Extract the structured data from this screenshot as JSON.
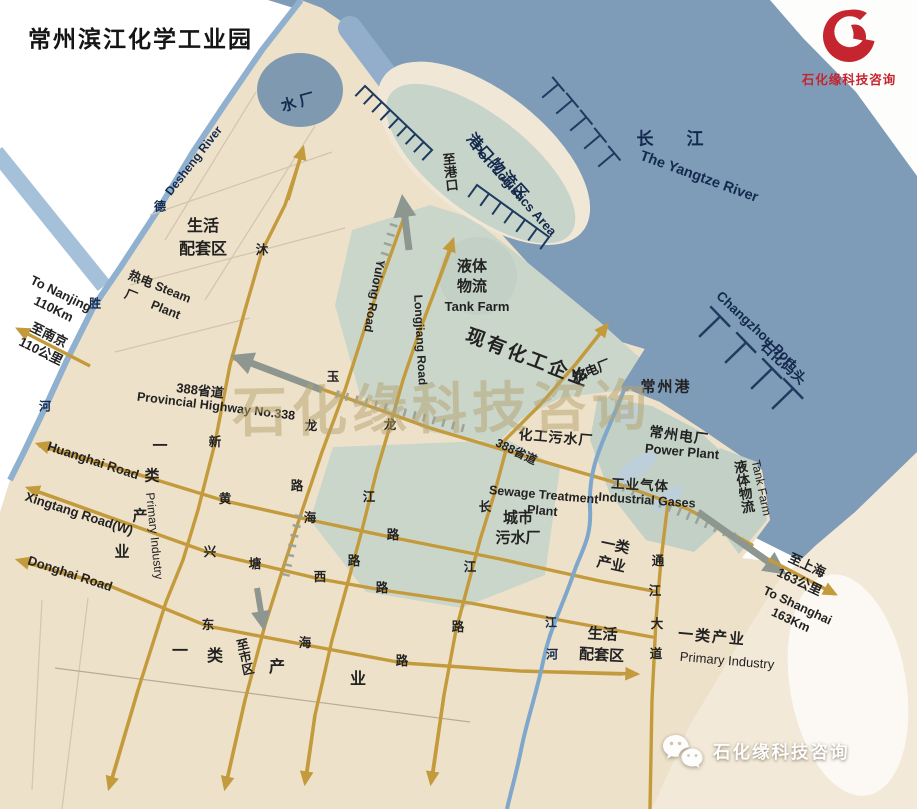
{
  "title": "常州滨江化学工业园",
  "brand": {
    "name": "石化缘科技咨询",
    "logo_color": "#c5252e"
  },
  "watermark": {
    "center_text": "石化缘科技咨询",
    "wechat_text": "石化缘科技咨询"
  },
  "colors": {
    "river": "#7e9bb8",
    "land": "#eee1ca",
    "zone": "#cbd6cb",
    "zone_dark": "#c2d0c5",
    "road": "#c49b3c",
    "rail": "#9aa096",
    "river_line": "#8fb0cf",
    "stream": "#7fa7cc",
    "water_plant": "#7e99b0",
    "pier": "#1d3a5f",
    "label_navy": "#13294d",
    "label_ink": "#222222",
    "cream": "#f2e9d8",
    "watermark_tan": "#b5a470",
    "arrow_gray": "#8e9690",
    "port_teal": "#c7d4c9",
    "port_rim": "#f1e7d6",
    "minor_line": "#d2c5ae",
    "pale_pond": "#bccfda"
  },
  "map": {
    "labels": [
      {
        "n": "label-water-plant",
        "t": "水厂",
        "x": 300,
        "y": 103,
        "s": 15,
        "b": 1,
        "c": "navy",
        "r": -15,
        "ls": 4
      },
      {
        "n": "label-to-port",
        "t": "至港口",
        "x": 449,
        "y": 172,
        "s": 13,
        "b": 1,
        "c": "ink",
        "v": 1,
        "r": -6
      },
      {
        "n": "label-port-logistics-cn",
        "t": "港口物流区",
        "x": 497,
        "y": 168,
        "s": 15,
        "b": 1,
        "c": "navy",
        "r": 48,
        "ls": 2
      },
      {
        "n": "label-port-logistics-en",
        "t": "Port Logistics Area",
        "x": 514,
        "y": 190,
        "s": 13,
        "b": 1,
        "c": "navy",
        "r": 48
      },
      {
        "n": "label-yangtze-cn",
        "t": "长　江",
        "x": 674,
        "y": 139,
        "s": 17,
        "b": 1,
        "c": "navy",
        "ls": 8
      },
      {
        "n": "label-yangtze-en",
        "t": "The Yangtze River",
        "x": 699,
        "y": 177,
        "s": 14.5,
        "b": 1,
        "c": "navy",
        "r": 20
      },
      {
        "n": "label-changzhou-port-en",
        "t": "Changzhou Port",
        "x": 756,
        "y": 330,
        "s": 13.5,
        "b": 1,
        "c": "navy",
        "r": 43
      },
      {
        "n": "label-shihua-wharf",
        "t": "石化码头",
        "x": 783,
        "y": 363,
        "s": 14,
        "b": 1,
        "c": "navy",
        "r": 43
      },
      {
        "n": "label-desheng-river-en",
        "t": "Desheng River",
        "x": 194,
        "y": 161,
        "s": 12,
        "b": 1,
        "c": "navy",
        "r": -52
      },
      {
        "n": "river-char",
        "t": "德",
        "x": 160,
        "y": 207,
        "s": 12,
        "b": 1,
        "c": "navy"
      },
      {
        "n": "river-char",
        "t": "胜",
        "x": 95,
        "y": 304,
        "s": 12,
        "b": 1,
        "c": "navy"
      },
      {
        "n": "river-char",
        "t": "河",
        "x": 45,
        "y": 407,
        "s": 12,
        "b": 1,
        "c": "navy"
      },
      {
        "n": "label-living-area-nw",
        "t": "生活\n配套区",
        "x": 203,
        "y": 238,
        "s": 16,
        "b": 1,
        "c": "ink",
        "lh": 1.45
      },
      {
        "n": "label-steam-plant",
        "t": "热电 Steam\n厂　 Plant",
        "x": 156,
        "y": 296,
        "s": 12.5,
        "b": 1,
        "c": "ink",
        "r": 22,
        "lh": 1.5
      },
      {
        "n": "label-to-nanjing-en",
        "t": "To Nanjing\n110Km",
        "x": 57,
        "y": 302,
        "s": 13,
        "b": 1,
        "c": "ink",
        "r": 26,
        "lh": 1.3
      },
      {
        "n": "label-to-nanjing-cn",
        "t": "至南京\n110公里",
        "x": 45,
        "y": 343,
        "s": 13,
        "b": 1,
        "c": "ink",
        "r": 26,
        "lh": 1.35
      },
      {
        "n": "label-hw388-w-cn",
        "t": "388省道",
        "x": 200,
        "y": 391,
        "s": 13,
        "b": 1,
        "c": "ink",
        "r": 7
      },
      {
        "n": "label-hw388-w-en",
        "t": "Provincial Highway No.338",
        "x": 216,
        "y": 407,
        "s": 12.5,
        "b": 1,
        "c": "ink",
        "r": 7
      },
      {
        "n": "label-tank-farm-n-cn",
        "t": "液体\n物流",
        "x": 472,
        "y": 277,
        "s": 15,
        "b": 1,
        "c": "ink",
        "lh": 1.35
      },
      {
        "n": "label-tank-farm-n-en",
        "t": "Tank Farm",
        "x": 477,
        "y": 307,
        "s": 13,
        "b": 1,
        "c": "ink"
      },
      {
        "n": "label-existing-chem",
        "t": "现有化工企业",
        "x": 528,
        "y": 359,
        "s": 19,
        "b": 1,
        "c": "ink",
        "r": 21,
        "ls": 3
      },
      {
        "n": "label-thermal-plant",
        "t": "热电厂",
        "x": 592,
        "y": 371,
        "s": 13,
        "b": 1,
        "c": "ink",
        "r": -22
      },
      {
        "n": "label-changzhou-port-cn",
        "t": "常州港",
        "x": 666,
        "y": 388,
        "s": 15,
        "b": 1,
        "c": "ink",
        "ls": 2
      },
      {
        "n": "label-power-plant-cn",
        "t": "常州电厂",
        "x": 679,
        "y": 436,
        "s": 14,
        "b": 1,
        "c": "ink",
        "r": 8,
        "ls": 1
      },
      {
        "n": "label-power-plant-en",
        "t": "Power Plant",
        "x": 682,
        "y": 452,
        "s": 13,
        "b": 1,
        "c": "ink",
        "r": 5
      },
      {
        "n": "label-chem-sewage",
        "t": "化工污水厂",
        "x": 556,
        "y": 438,
        "s": 14,
        "b": 1,
        "c": "ink",
        "r": 5,
        "ls": 1
      },
      {
        "n": "label-hw388-mid",
        "t": "388省道",
        "x": 516,
        "y": 452,
        "s": 12,
        "b": 1,
        "c": "ink",
        "r": 26
      },
      {
        "n": "label-sewage-en",
        "t": "Sewage Treatment\nPlant",
        "x": 543,
        "y": 503,
        "s": 12.5,
        "b": 1,
        "c": "ink",
        "r": 5,
        "lh": 1.3
      },
      {
        "n": "label-city-sewage",
        "t": "城市\n污水厂",
        "x": 518,
        "y": 528,
        "s": 15,
        "b": 1,
        "c": "ink",
        "lh": 1.3
      },
      {
        "n": "label-industrial-gases-cn",
        "t": "工业气体",
        "x": 640,
        "y": 486,
        "s": 13.5,
        "b": 1,
        "c": "ink",
        "r": 3,
        "ls": 1
      },
      {
        "n": "label-industrial-gases-en",
        "t": "Industrial Gases",
        "x": 647,
        "y": 501,
        "s": 12.5,
        "b": 1,
        "c": "ink",
        "r": 4
      },
      {
        "n": "label-tank-farm-e-cn",
        "t": "液体物流",
        "x": 742,
        "y": 487,
        "s": 13.5,
        "b": 1,
        "c": "ink",
        "v": 1,
        "r": -10
      },
      {
        "n": "label-tank-farm-e-en",
        "t": "Tank Farm",
        "x": 761,
        "y": 488,
        "s": 12,
        "b": 0,
        "c": "ink",
        "r": 78
      },
      {
        "n": "label-primary-industry-e",
        "t": "一类\n产业",
        "x": 613,
        "y": 556,
        "s": 14.5,
        "b": 1,
        "c": "ink",
        "r": 12,
        "lh": 1.3
      },
      {
        "n": "road-char",
        "t": "通",
        "x": 658,
        "y": 562,
        "s": 12.5,
        "b": 1,
        "c": "ink"
      },
      {
        "n": "road-char",
        "t": "江",
        "x": 655,
        "y": 592,
        "s": 12.5,
        "b": 1,
        "c": "ink"
      },
      {
        "n": "road-char",
        "t": "大",
        "x": 657,
        "y": 625,
        "s": 12.5,
        "b": 1,
        "c": "ink"
      },
      {
        "n": "road-char",
        "t": "道",
        "x": 656,
        "y": 655,
        "s": 12.5,
        "b": 1,
        "c": "ink"
      },
      {
        "n": "label-to-shanghai-cn",
        "t": "至上海\n163公里",
        "x": 803,
        "y": 574,
        "s": 13,
        "b": 1,
        "c": "ink",
        "r": 25,
        "lh": 1.4
      },
      {
        "n": "label-to-shanghai-en",
        "t": "To Shanghai\n163Km",
        "x": 794,
        "y": 613,
        "s": 12.5,
        "b": 1,
        "c": "ink",
        "r": 25,
        "lh": 1.3
      },
      {
        "n": "label-primary-industry-se-cn",
        "t": "一类产业",
        "x": 712,
        "y": 638,
        "s": 15,
        "b": 1,
        "c": "ink",
        "ls": 2,
        "r": 5
      },
      {
        "n": "label-primary-industry-se-en",
        "t": "Primary Industry",
        "x": 727,
        "y": 661,
        "s": 13,
        "b": 0,
        "c": "ink",
        "r": 5
      },
      {
        "n": "label-living-area-s",
        "t": "生活\n配套区",
        "x": 602,
        "y": 645,
        "s": 15,
        "b": 1,
        "c": "ink",
        "r": 3,
        "lh": 1.4
      },
      {
        "n": "label-huanghai-road",
        "t": "Huanghai Road",
        "x": 93,
        "y": 461,
        "s": 13,
        "b": 1,
        "c": "ink",
        "r": 18
      },
      {
        "n": "label-xingtang-road",
        "t": "Xingtang Road(W)",
        "x": 79,
        "y": 514,
        "s": 13,
        "b": 1,
        "c": "ink",
        "r": 18
      },
      {
        "n": "label-donghai-road",
        "t": "Donghai Road",
        "x": 70,
        "y": 574,
        "s": 13,
        "b": 1,
        "c": "ink",
        "r": 18
      },
      {
        "n": "label-primary-industry-w-char",
        "t": "一",
        "x": 160,
        "y": 447,
        "s": 15,
        "b": 1,
        "c": "ink"
      },
      {
        "n": "label-primary-industry-w-char",
        "t": "类",
        "x": 152,
        "y": 477,
        "s": 15,
        "b": 1,
        "c": "ink"
      },
      {
        "n": "label-primary-industry-w-char",
        "t": "产",
        "x": 140,
        "y": 517,
        "s": 15,
        "b": 1,
        "c": "ink"
      },
      {
        "n": "label-primary-industry-w-char",
        "t": "业",
        "x": 122,
        "y": 553,
        "s": 15,
        "b": 1,
        "c": "ink"
      },
      {
        "n": "label-primary-industry-w-en",
        "t": "Primary Industry",
        "x": 154,
        "y": 536,
        "s": 12,
        "b": 0,
        "c": "ink",
        "r": 84
      },
      {
        "n": "label-yulong-road",
        "t": "Yulong Road",
        "x": 374,
        "y": 296,
        "s": 12,
        "b": 1,
        "c": "ink",
        "r": 100
      },
      {
        "n": "label-longjiang-road",
        "t": "Longjiang Road",
        "x": 420,
        "y": 340,
        "s": 12,
        "b": 1,
        "c": "ink",
        "r": 87
      },
      {
        "n": "road-char",
        "t": "玉",
        "x": 333,
        "y": 378,
        "s": 12.5,
        "b": 1,
        "c": "ink"
      },
      {
        "n": "road-char",
        "t": "龙",
        "x": 311,
        "y": 427,
        "s": 12.5,
        "b": 1,
        "c": "ink"
      },
      {
        "n": "road-char",
        "t": "路",
        "x": 297,
        "y": 487,
        "s": 12.5,
        "b": 1,
        "c": "ink"
      },
      {
        "n": "road-char",
        "t": "沐",
        "x": 262,
        "y": 251,
        "s": 12.5,
        "b": 1,
        "c": "ink"
      },
      {
        "n": "road-char",
        "t": "新",
        "x": 215,
        "y": 443,
        "s": 12.5,
        "b": 1,
        "c": "ink"
      },
      {
        "n": "road-char",
        "t": "龙",
        "x": 390,
        "y": 426,
        "s": 12.5,
        "b": 1,
        "c": "ink"
      },
      {
        "n": "road-char",
        "t": "江",
        "x": 369,
        "y": 498,
        "s": 12.5,
        "b": 1,
        "c": "ink"
      },
      {
        "n": "road-char",
        "t": "路",
        "x": 354,
        "y": 562,
        "s": 12.5,
        "b": 1,
        "c": "ink"
      },
      {
        "n": "road-char",
        "t": "长",
        "x": 485,
        "y": 508,
        "s": 12.5,
        "b": 1,
        "c": "ink"
      },
      {
        "n": "road-char",
        "t": "江",
        "x": 470,
        "y": 568,
        "s": 12.5,
        "b": 1,
        "c": "ink"
      },
      {
        "n": "road-char",
        "t": "路",
        "x": 458,
        "y": 628,
        "s": 12.5,
        "b": 1,
        "c": "ink"
      },
      {
        "n": "road-char",
        "t": "黄",
        "x": 225,
        "y": 500,
        "s": 12.5,
        "b": 1,
        "c": "ink"
      },
      {
        "n": "road-char",
        "t": "海",
        "x": 310,
        "y": 519,
        "s": 12.5,
        "b": 1,
        "c": "ink"
      },
      {
        "n": "road-char",
        "t": "路",
        "x": 393,
        "y": 536,
        "s": 12.5,
        "b": 1,
        "c": "ink"
      },
      {
        "n": "road-char",
        "t": "兴",
        "x": 210,
        "y": 553,
        "s": 12.5,
        "b": 1,
        "c": "ink"
      },
      {
        "n": "road-char",
        "t": "塘",
        "x": 255,
        "y": 565,
        "s": 12.5,
        "b": 1,
        "c": "ink"
      },
      {
        "n": "road-char",
        "t": "西",
        "x": 320,
        "y": 578,
        "s": 12.5,
        "b": 1,
        "c": "ink"
      },
      {
        "n": "road-char",
        "t": "路",
        "x": 382,
        "y": 589,
        "s": 12.5,
        "b": 1,
        "c": "ink"
      },
      {
        "n": "road-char",
        "t": "东",
        "x": 208,
        "y": 626,
        "s": 12.5,
        "b": 1,
        "c": "ink"
      },
      {
        "n": "road-char",
        "t": "海",
        "x": 305,
        "y": 644,
        "s": 12.5,
        "b": 1,
        "c": "ink"
      },
      {
        "n": "road-char",
        "t": "路",
        "x": 402,
        "y": 662,
        "s": 12.5,
        "b": 1,
        "c": "ink"
      },
      {
        "n": "label-to-city",
        "t": "至市区",
        "x": 243,
        "y": 657,
        "s": 12.5,
        "b": 1,
        "c": "ink",
        "v": 1,
        "r": -12
      },
      {
        "n": "label-primary-industry-s-char",
        "t": "一",
        "x": 180,
        "y": 652,
        "s": 16,
        "b": 1,
        "c": "ink"
      },
      {
        "n": "label-primary-industry-s-char",
        "t": "类",
        "x": 215,
        "y": 657,
        "s": 16,
        "b": 1,
        "c": "ink"
      },
      {
        "n": "label-primary-industry-s-char",
        "t": "产",
        "x": 277,
        "y": 668,
        "s": 16,
        "b": 1,
        "c": "ink"
      },
      {
        "n": "label-primary-industry-s-char",
        "t": "业",
        "x": 358,
        "y": 680,
        "s": 16,
        "b": 1,
        "c": "ink"
      },
      {
        "n": "river-char",
        "t": "江",
        "x": 551,
        "y": 623,
        "s": 12,
        "b": 1,
        "c": "navy"
      },
      {
        "n": "river-char",
        "t": "河",
        "x": 552,
        "y": 655,
        "s": 12,
        "b": 1,
        "c": "navy"
      }
    ]
  }
}
